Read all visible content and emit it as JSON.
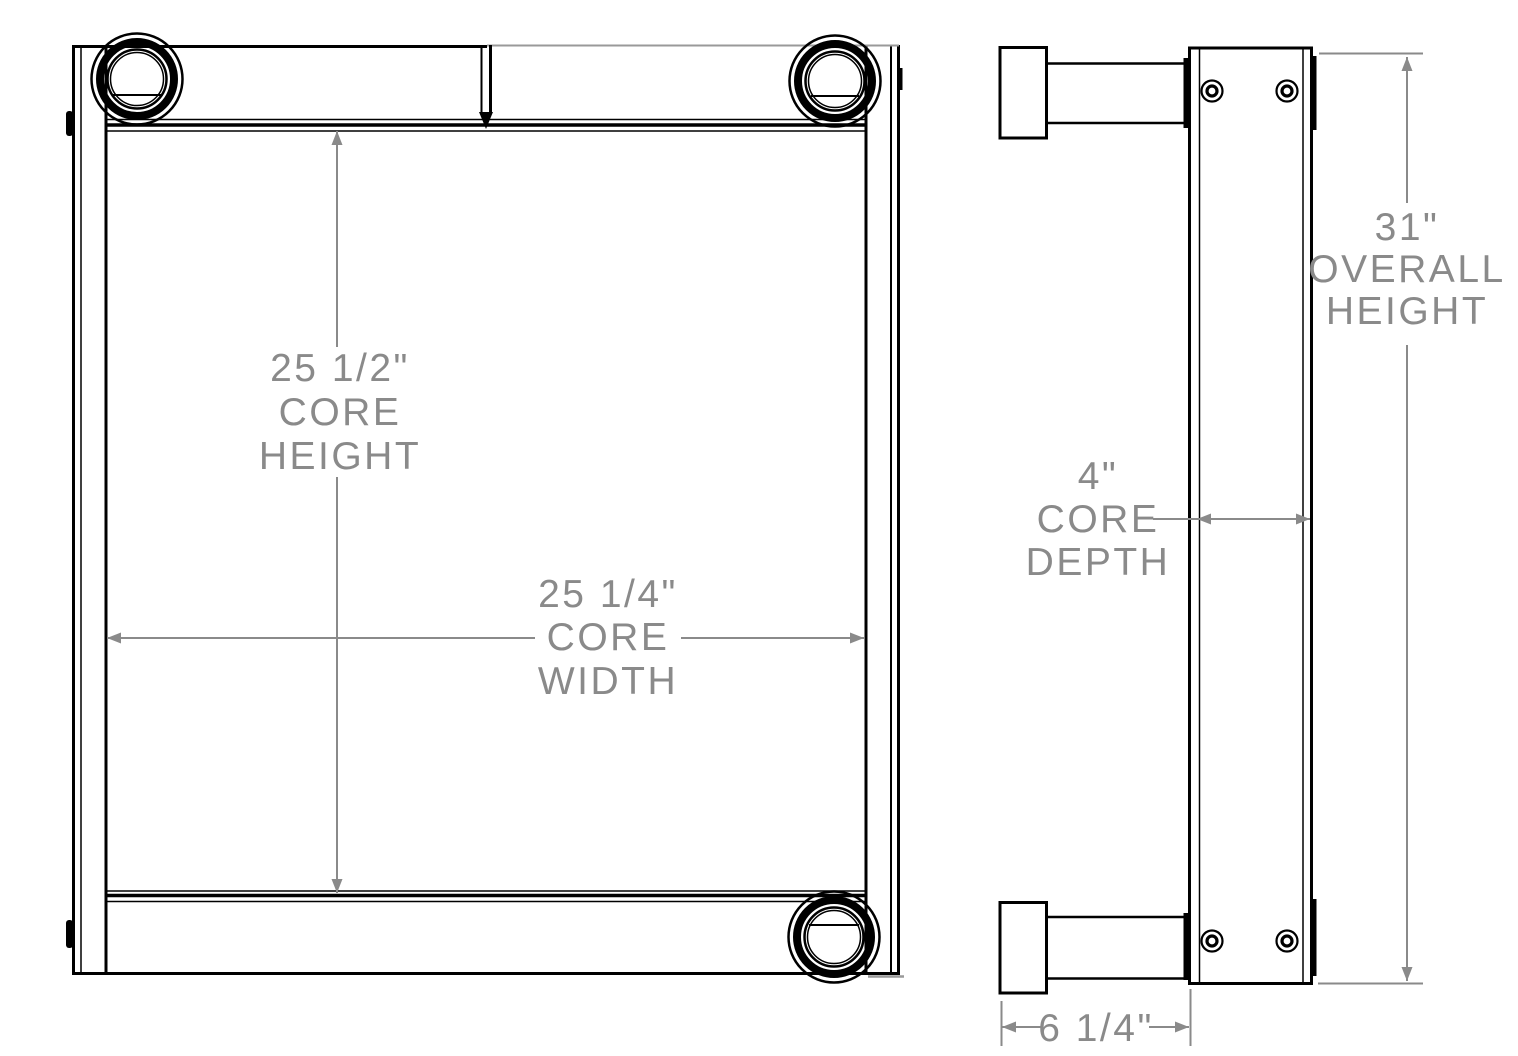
{
  "drawing_type": "technical-dimension-drawing",
  "views": {
    "front_view": "front-view",
    "side_view": "side-view"
  },
  "dimensions": {
    "core_height": {
      "value": "25 1/2\"",
      "label_line1": "CORE",
      "label_line2": "HEIGHT"
    },
    "core_width": {
      "value": "25 1/4\"",
      "label_line1": "CORE",
      "label_line2": "WIDTH"
    },
    "core_depth": {
      "value": "4\"",
      "label_line1": "CORE",
      "label_line2": "DEPTH"
    },
    "overall_height": {
      "value": "31\"",
      "label_line1": "OVERALL",
      "label_line2": "HEIGHT"
    },
    "overall_depth": {
      "value": "6 1/4\""
    }
  },
  "colors": {
    "line": "#000000",
    "dimension": "#8a8a8a",
    "light_line": "#999999",
    "background": "#ffffff"
  }
}
